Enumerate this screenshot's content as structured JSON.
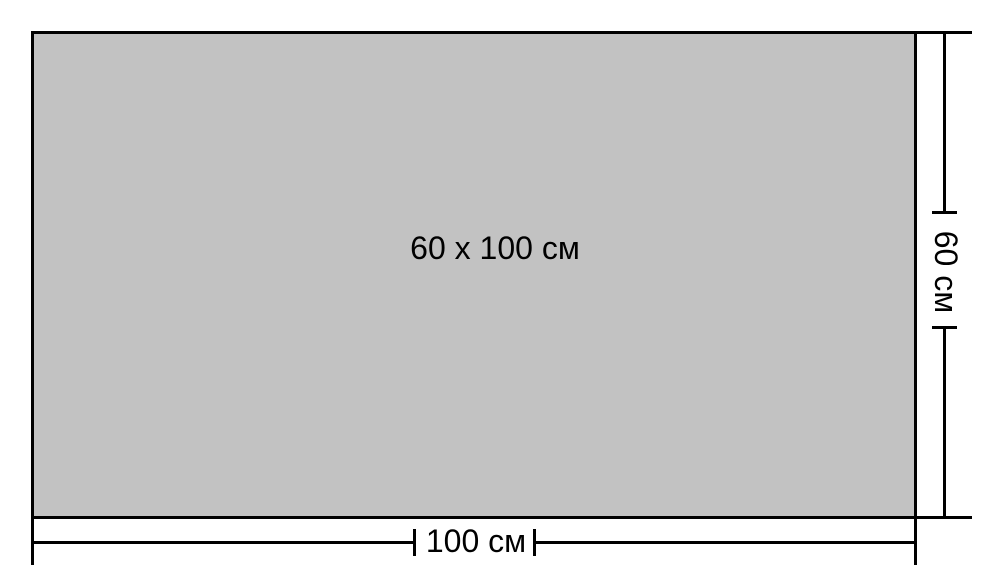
{
  "diagram": {
    "area_label": "60 x 100 см",
    "width_dimension": {
      "label": "100 см"
    },
    "height_dimension": {
      "label": "60 см"
    },
    "colors": {
      "panel_fill": "#c2c2c2",
      "line": "#000000",
      "background": "#ffffff",
      "text": "#000000"
    }
  }
}
